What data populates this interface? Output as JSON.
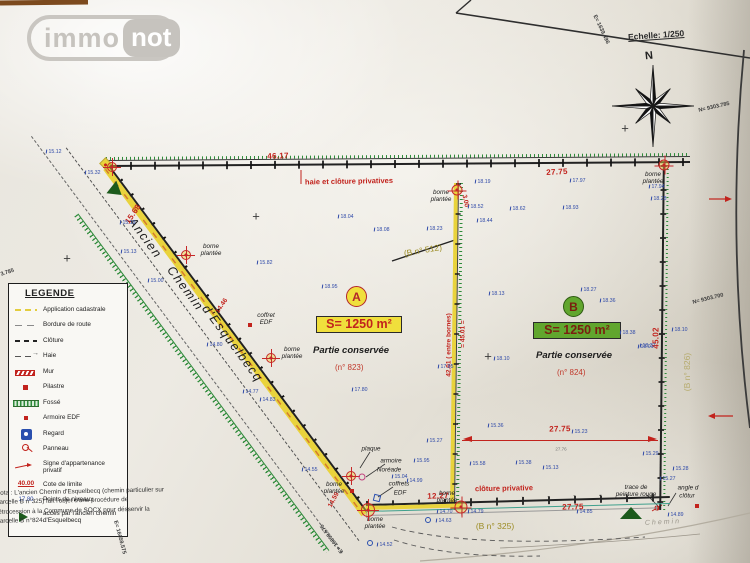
{
  "logo": {
    "immo": "immo",
    "not": "not"
  },
  "header": {
    "scale": "Echelle: 1/250",
    "north": "N"
  },
  "road": {
    "words": [
      "Ancien",
      "Chemin",
      "d'Esquelbecq"
    ]
  },
  "parcels": {
    "a": {
      "letter": "A",
      "area": "S= 1250 m²",
      "kept": "Partie conservée",
      "number": "(n° 823)"
    },
    "b": {
      "letter": "B",
      "area": "S= 1250 m²",
      "kept": "Partie conservée",
      "number": "(n° 824)"
    }
  },
  "note": "Nota : L'ancien Chemin d'Esquelbecq (chemin particulier sur\nparcelle B n°325) fait l'objet d'une procédure de\nrétrocession à la Commune de SOCX pour désservir la\nparcelle B n°824.",
  "legend": {
    "title": "LEGENDE",
    "items": [
      {
        "symbol": "app",
        "label": "Application cadastrale"
      },
      {
        "symbol": "bord",
        "label": "Bordure de route"
      },
      {
        "symbol": "clot",
        "label": "Clôture"
      },
      {
        "symbol": "haie",
        "label": "Haie"
      },
      {
        "symbol": "mur",
        "label": "Mur"
      },
      {
        "symbol": "pil",
        "label": "Pilastre"
      },
      {
        "symbol": "fos",
        "label": "Fossé"
      },
      {
        "symbol": "arm",
        "label": "Armoire EDF"
      },
      {
        "symbol": "reg",
        "label": "Regard"
      },
      {
        "symbol": "pan",
        "label": "Panneau"
      },
      {
        "symbol": "sig",
        "label": "Signe d'appartenance privatif"
      },
      {
        "symbol": "cote",
        "label": "Cote de limite",
        "symbol_text": "40.00"
      },
      {
        "symbol": "niv",
        "label": "Points de niveaux",
        "symbol_text": "17.80"
      },
      {
        "symbol": "acces",
        "label": "accès par l'ancien chemin d'Esquelbecq"
      }
    ]
  },
  "coords": [
    {
      "t": "E= 1639.496",
      "x": 597,
      "y": 14,
      "r": 65
    },
    {
      "t": "N= 9303.785",
      "x": 698,
      "y": 108,
      "r": -13
    },
    {
      "t": "N= 9303.700",
      "x": 692,
      "y": 300,
      "r": -14
    },
    {
      "t": "3.785",
      "x": 0,
      "y": 272,
      "r": -18
    },
    {
      "t": "E= 16059.575",
      "x": 118,
      "y": 520,
      "r": 75
    },
    {
      "t": "E= 16059.575",
      "x": 340,
      "y": 554,
      "r": 233
    }
  ],
  "labels": [
    {
      "t": "46.17",
      "x": 278,
      "y": 156,
      "r": -2,
      "c": "dim"
    },
    {
      "t": "27.75",
      "x": 557,
      "y": 172,
      "r": -3,
      "c": "dim"
    },
    {
      "t": "haie et clôture privatives",
      "x": 349,
      "y": 182,
      "r": -1,
      "c": "redlab"
    },
    {
      "t": "3.00",
      "x": 465,
      "y": 201,
      "r": 78,
      "c": "dims"
    },
    {
      "t": "42.01 ( entre bornes)",
      "x": 449,
      "y": 345,
      "r": -90,
      "c": "dims"
    },
    {
      "t": "= 45.01 =",
      "x": 463,
      "y": 334,
      "r": -90,
      "c": "dims"
    },
    {
      "t": "45.02",
      "x": 656,
      "y": 338,
      "r": -90,
      "c": "dim"
    },
    {
      "t": "15.68",
      "x": 133,
      "y": 214,
      "r": -56,
      "c": "dim"
    },
    {
      "t": "14.46",
      "x": 222,
      "y": 306,
      "r": -56,
      "c": "dims"
    },
    {
      "t": "14.59",
      "x": 334,
      "y": 500,
      "r": -62,
      "c": "dims"
    },
    {
      "t": "12.27",
      "x": 438,
      "y": 496,
      "r": -2,
      "c": "dim"
    },
    {
      "t": "27.75",
      "x": 560,
      "y": 429,
      "r": -1,
      "c": "dim"
    },
    {
      "t": "27.76",
      "x": 561,
      "y": 449,
      "r": 0,
      "c": "tiny"
    },
    {
      "t": "27.75",
      "x": 573,
      "y": 507,
      "r": -1,
      "c": "dim"
    },
    {
      "t": "clôture privative",
      "x": 504,
      "y": 489,
      "r": -1,
      "c": "redlab"
    },
    {
      "t": "borne\nplantée",
      "x": 211,
      "y": 250,
      "r": 0,
      "c": "it"
    },
    {
      "t": "borne\nplantée",
      "x": 292,
      "y": 353,
      "r": 0,
      "c": "it"
    },
    {
      "t": "borne\nplantée",
      "x": 334,
      "y": 488,
      "r": 0,
      "c": "it"
    },
    {
      "t": "borne\nplantée",
      "x": 441,
      "y": 196,
      "r": 0,
      "c": "it"
    },
    {
      "t": "borne\nplantée",
      "x": 447,
      "y": 497,
      "r": 0,
      "c": "it"
    },
    {
      "t": "borne\nplantée",
      "x": 653,
      "y": 178,
      "r": 0,
      "c": "it"
    },
    {
      "t": "borne\nplantée",
      "x": 375,
      "y": 523,
      "r": 0,
      "c": "it"
    },
    {
      "t": "coffret\nEDF",
      "x": 266,
      "y": 319,
      "r": 0,
      "c": "it"
    },
    {
      "t": "plaque",
      "x": 371,
      "y": 449,
      "r": 0,
      "c": "it"
    },
    {
      "t": "armoire",
      "x": 391,
      "y": 461,
      "r": 0,
      "c": "it"
    },
    {
      "t": "Noréade",
      "x": 389,
      "y": 470,
      "r": 0,
      "c": "it"
    },
    {
      "t": "coffrets",
      "x": 399,
      "y": 484,
      "r": 0,
      "c": "it"
    },
    {
      "t": "EDF",
      "x": 400,
      "y": 493,
      "r": 0,
      "c": "it"
    },
    {
      "t": "trace de\npeinture rouge",
      "x": 636,
      "y": 491,
      "r": 0,
      "c": "it"
    },
    {
      "t": "angle d",
      "x": 688,
      "y": 488,
      "r": 0,
      "c": "it"
    },
    {
      "t": "clôtur",
      "x": 687,
      "y": 496,
      "r": 0,
      "c": "it"
    },
    {
      "t": "(B n° 512)",
      "x": 423,
      "y": 251,
      "r": -10,
      "c": "olv"
    },
    {
      "t": "(B n° 325)",
      "x": 495,
      "y": 527,
      "r": 0,
      "c": "olv"
    },
    {
      "t": "(B n° 826)",
      "x": 688,
      "y": 372,
      "r": -90,
      "c": "olvf"
    },
    {
      "t": "Chemin",
      "x": 663,
      "y": 523,
      "r": -3,
      "c": "ghost"
    }
  ],
  "levels": [
    [
      46,
      152,
      "15.12"
    ],
    [
      85,
      173,
      "15.32"
    ],
    [
      120,
      223,
      "15.19"
    ],
    [
      121,
      252,
      "15.13"
    ],
    [
      148,
      281,
      "15.00"
    ],
    [
      257,
      263,
      "15.82"
    ],
    [
      207,
      345,
      "14.80"
    ],
    [
      243,
      392,
      "14.77"
    ],
    [
      260,
      400,
      "14.83"
    ],
    [
      302,
      470,
      "14.55"
    ],
    [
      338,
      217,
      "18.04"
    ],
    [
      374,
      230,
      "18.08"
    ],
    [
      427,
      229,
      "18.23"
    ],
    [
      322,
      287,
      "18.95"
    ],
    [
      352,
      390,
      "17.80"
    ],
    [
      475,
      182,
      "18.19"
    ],
    [
      468,
      207,
      "18.52"
    ],
    [
      477,
      221,
      "18.44"
    ],
    [
      489,
      294,
      "18.13"
    ],
    [
      494,
      359,
      "18.10"
    ],
    [
      438,
      367,
      "17.85"
    ],
    [
      488,
      426,
      "15.36"
    ],
    [
      427,
      441,
      "15.27"
    ],
    [
      510,
      209,
      "18.62"
    ],
    [
      563,
      208,
      "18.93"
    ],
    [
      570,
      181,
      "17.97"
    ],
    [
      581,
      290,
      "18.27"
    ],
    [
      600,
      301,
      "18.36"
    ],
    [
      620,
      333,
      "18.38"
    ],
    [
      640,
      346,
      "18.37"
    ],
    [
      649,
      187,
      "17.94"
    ],
    [
      651,
      199,
      "18.28"
    ],
    [
      672,
      330,
      "18.10"
    ],
    [
      638,
      347,
      "18.01"
    ],
    [
      572,
      432,
      "15.23"
    ],
    [
      643,
      454,
      "15.29"
    ],
    [
      673,
      469,
      "15.28"
    ],
    [
      660,
      479,
      "15.27"
    ],
    [
      668,
      515,
      "14.89"
    ],
    [
      543,
      468,
      "15.13"
    ],
    [
      577,
      512,
      "14.85"
    ],
    [
      392,
      477,
      "15.04"
    ],
    [
      407,
      481,
      "14.99"
    ],
    [
      414,
      461,
      "15.95"
    ],
    [
      470,
      464,
      "15.58"
    ],
    [
      516,
      463,
      "15.38"
    ],
    [
      437,
      512,
      "14.70"
    ],
    [
      468,
      512,
      "14.79"
    ],
    [
      436,
      521,
      "14.63"
    ],
    [
      377,
      545,
      "14.52"
    ]
  ],
  "bornes": [
    [
      112,
      167,
      10
    ],
    [
      186,
      255,
      10
    ],
    [
      271,
      358,
      10
    ],
    [
      351,
      476,
      10
    ],
    [
      368,
      510,
      14
    ],
    [
      457,
      190,
      11
    ],
    [
      461,
      507,
      13
    ],
    [
      664,
      165,
      11
    ]
  ],
  "crosses": [
    [
      256,
      216
    ],
    [
      67,
      258
    ],
    [
      488,
      356
    ],
    [
      625,
      128
    ]
  ],
  "marks": {
    "red_squares": [
      [
        250,
        325
      ],
      [
        352,
        491
      ],
      [
        697,
        506
      ]
    ],
    "magenta_circles": [
      [
        362,
        477
      ]
    ],
    "blue_circles": [
      [
        370,
        543
      ],
      [
        428,
        520
      ]
    ],
    "blue_squares": [
      [
        377,
        498
      ]
    ]
  },
  "colors": {
    "accent_red": "#c2231d",
    "cadastral_yellow": "#e9d33c",
    "fosse_green": "#2e8b3a",
    "level_blue": "#2e49a8",
    "olive": "#9d8d26"
  }
}
